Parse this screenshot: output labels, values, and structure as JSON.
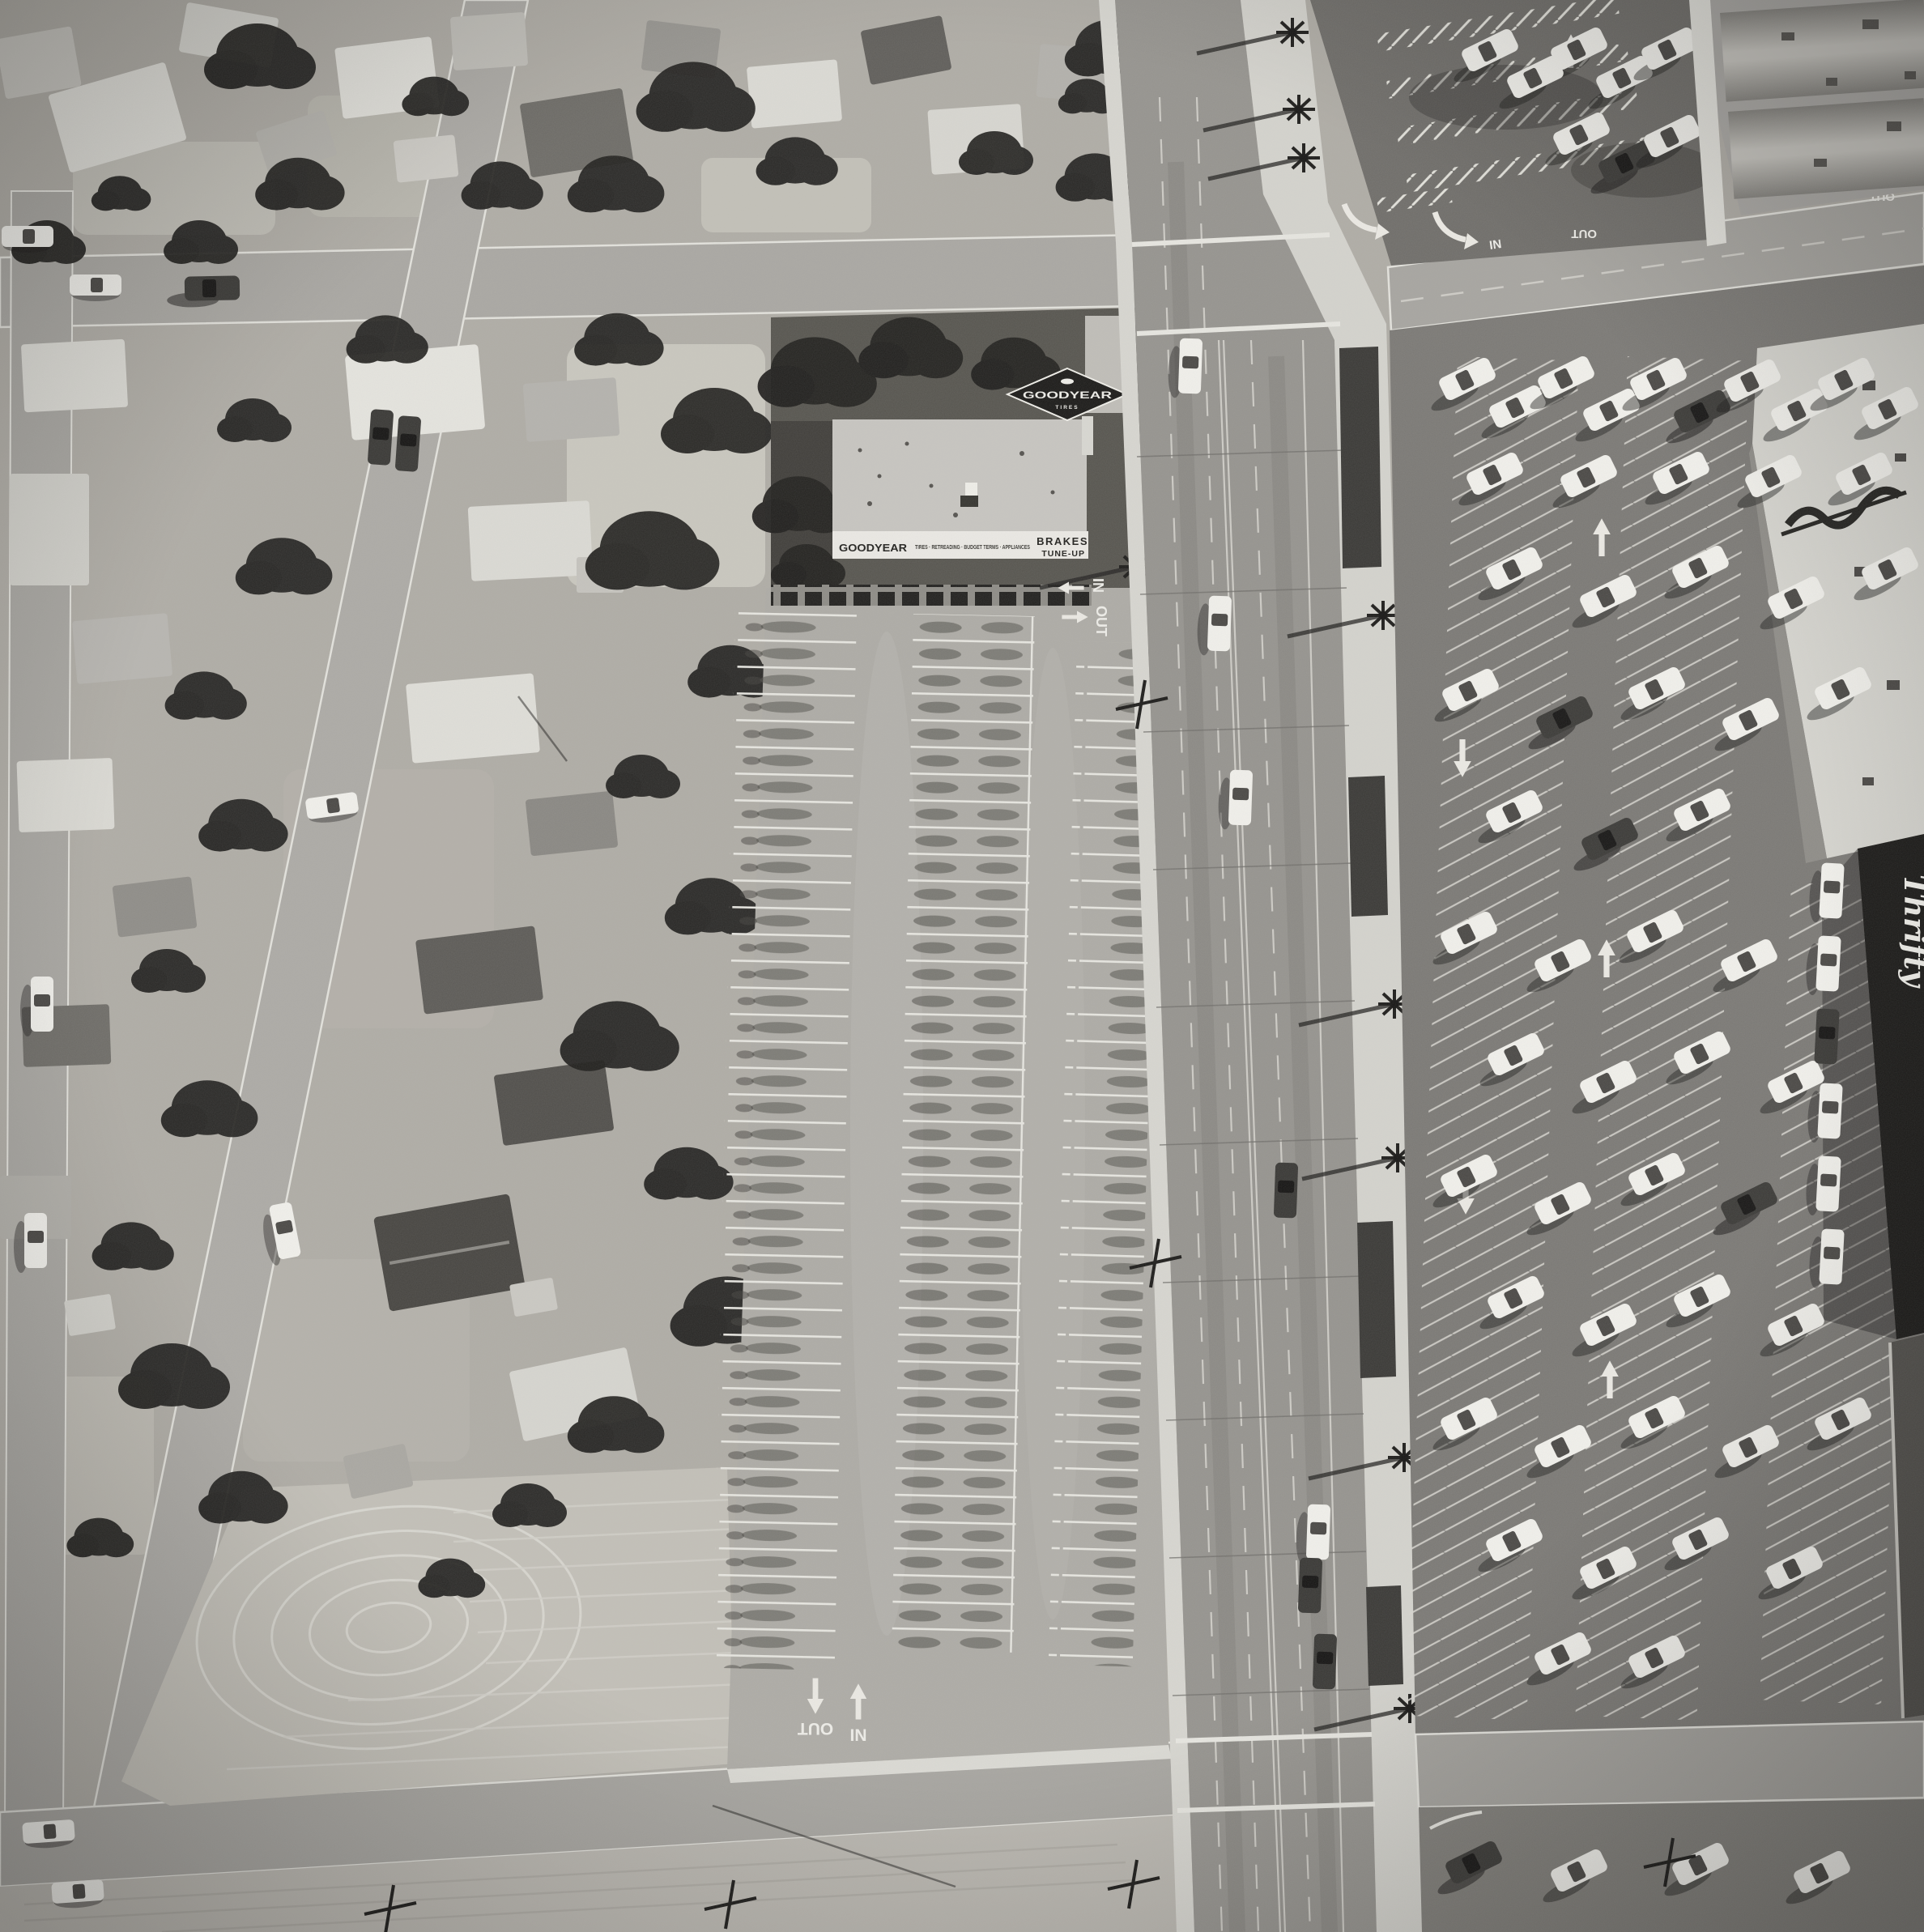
{
  "signs": {
    "goodyear_diamond": {
      "brand": "GOODYEAR",
      "product": "TIRES"
    },
    "storefront": {
      "brand": "GOODYEAR",
      "services": "TIRES · RETREADING · BUDGET TERMS · APPLIANCES",
      "brakes": "BRAKES",
      "tune_up": "TUNE-UP"
    },
    "drugstore_vertical": "Thrifty"
  },
  "pavement_markings": {
    "in": "IN",
    "out": "OUT"
  },
  "palette": {
    "ink_black": "#1b1a18",
    "tree_black": "#23221f",
    "car_white": "#f4f3ef",
    "stall_line_white": "#e8e7e1",
    "lot_light_gray": "#aeaca6",
    "asphalt_dark_gray": "#7b7975",
    "pavement_mid_gray": "#a8a6a1",
    "roof_white": "#e4e3dd"
  }
}
